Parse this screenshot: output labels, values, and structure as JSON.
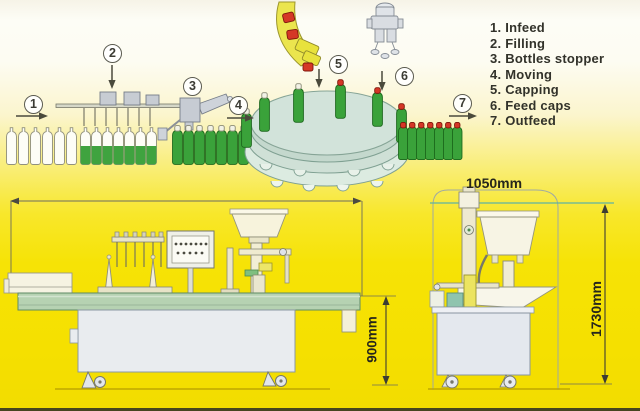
{
  "legend": {
    "items": [
      "1. Infeed",
      "2. Filling",
      "3. Bottles stopper",
      "4. Moving",
      "5. Capping",
      "6. Feed caps",
      "7. Outfeed"
    ]
  },
  "station_markers": [
    "1",
    "2",
    "3",
    "4",
    "5",
    "6",
    "7"
  ],
  "dimensions": {
    "left_machine_height": "900mm",
    "right_machine_width": "1050mm",
    "right_machine_height": "1730mm"
  },
  "colors": {
    "background_yellow": "#f5e000",
    "bottle_green": "#3aa23a",
    "cap_red": "#d53726",
    "turntable_teal": "#d2e3da",
    "table_green": "#b6d2b2",
    "cabinet_grey": "#e9ecef",
    "chute_yellow": "#ebe54e"
  }
}
